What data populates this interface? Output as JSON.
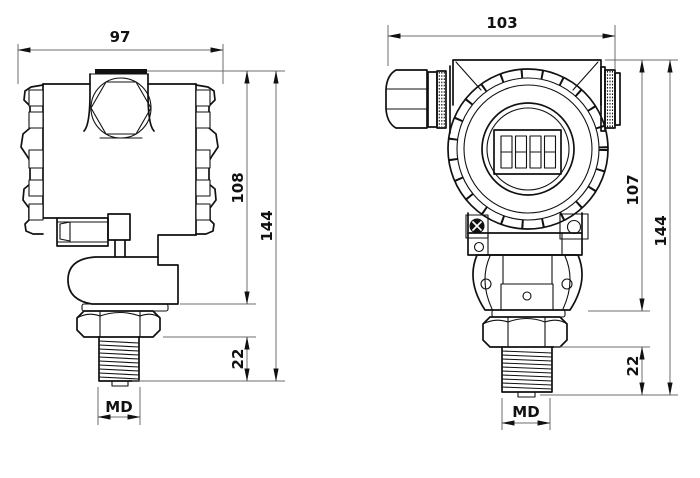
{
  "side_view": {
    "dim_width": "97",
    "dim_housing_height": "108",
    "dim_total_height": "144",
    "dim_thread_length": "22",
    "dim_thread_size": "MD"
  },
  "front_view": {
    "dim_width": "103",
    "dim_housing_height": "107",
    "dim_total_height": "144",
    "dim_thread_length": "22",
    "dim_thread_size": "MD"
  },
  "style": {
    "background": "#ffffff",
    "line_color": "#111111",
    "dimension_line_color": "#6e6e6e",
    "text_color": "#111111"
  }
}
